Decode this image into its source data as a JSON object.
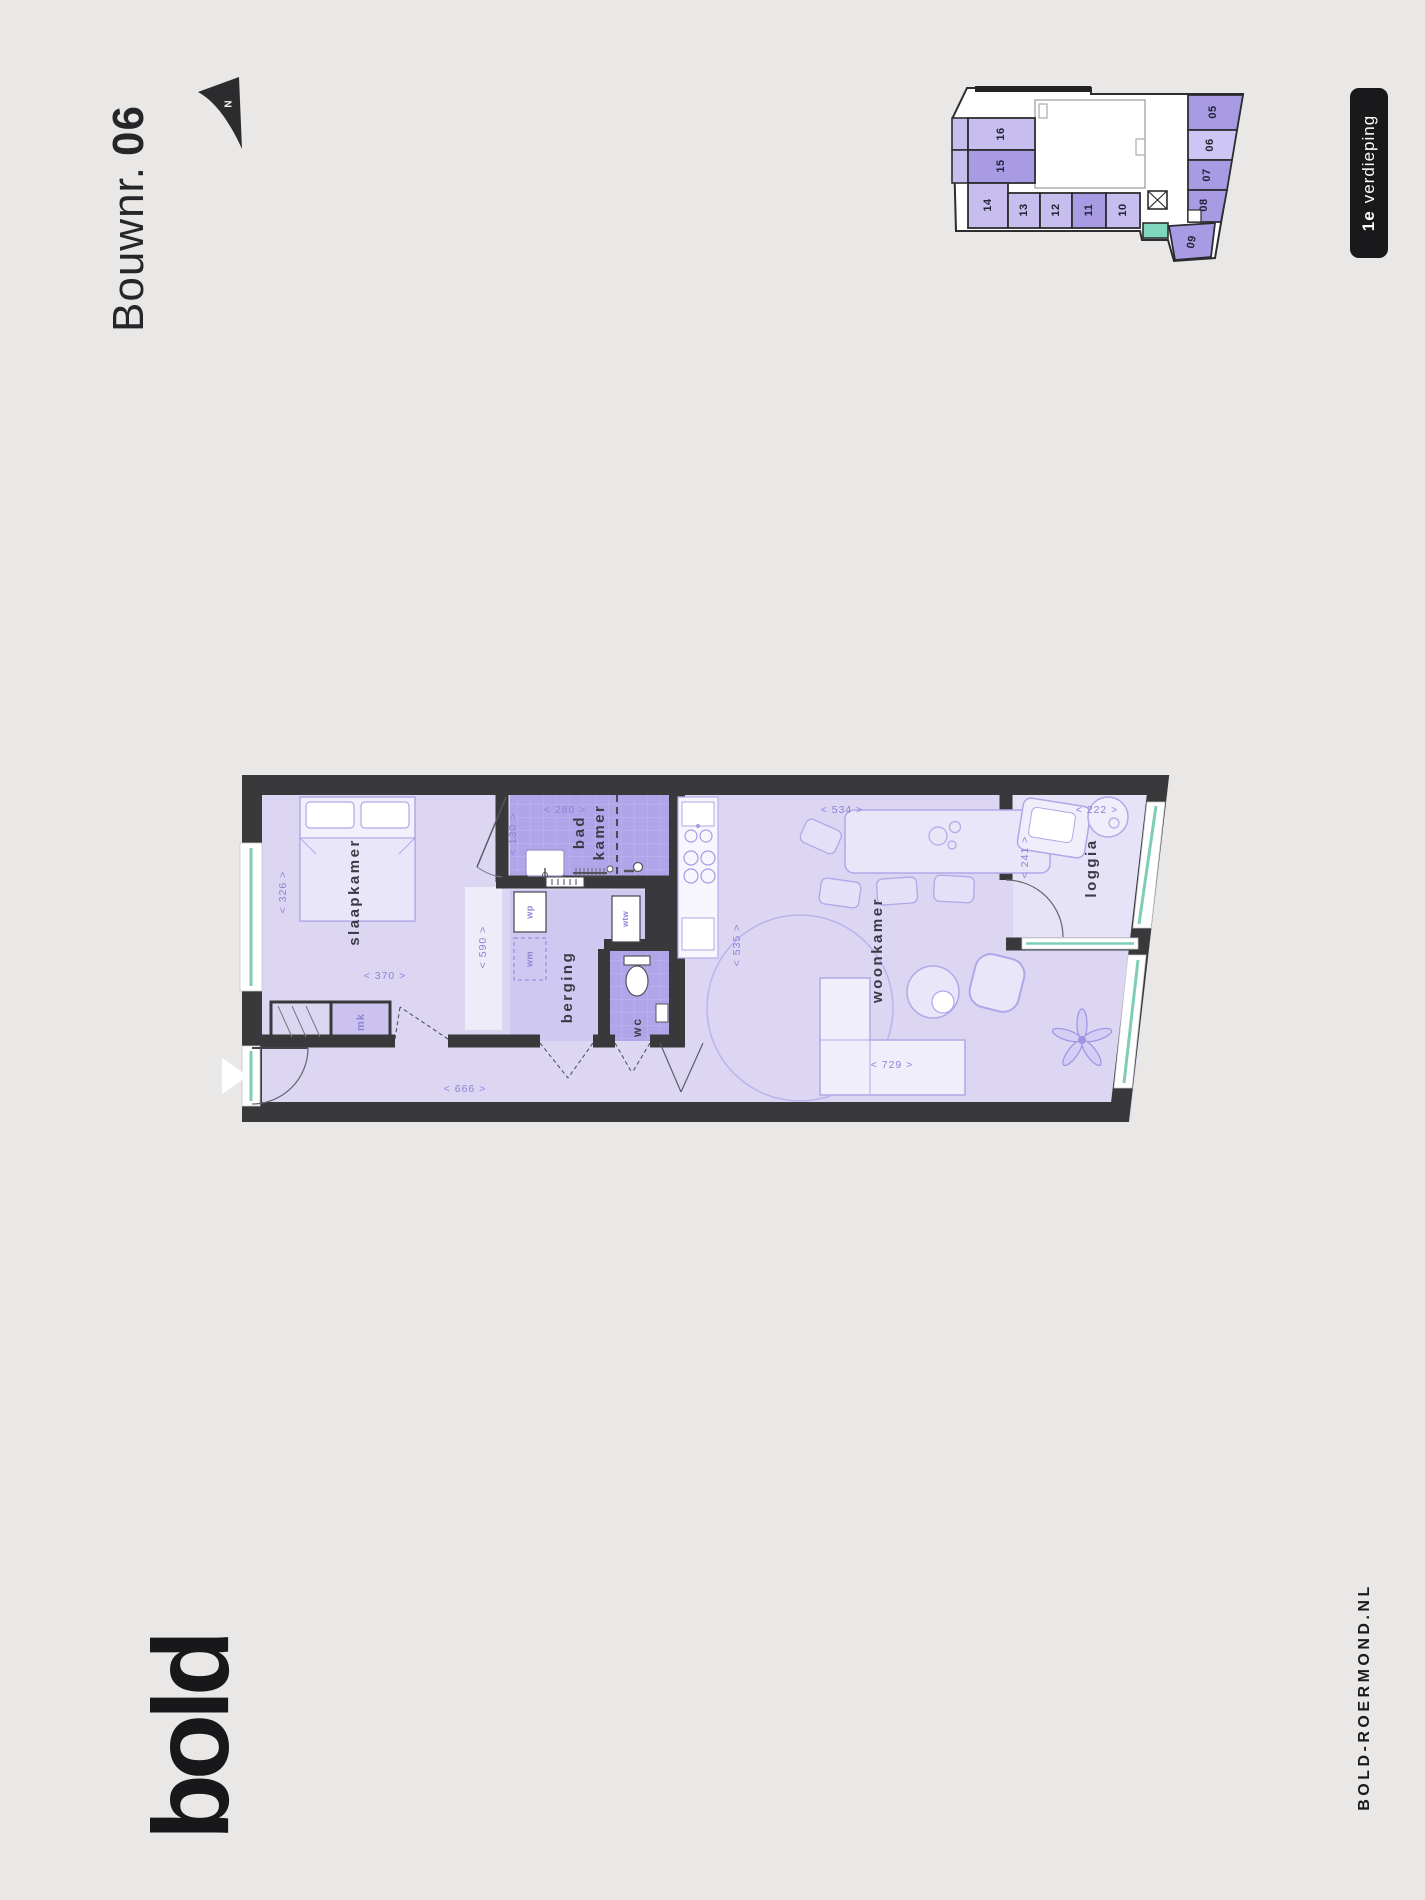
{
  "header": {
    "title_prefix": "Bouwnr.",
    "title_number": "06",
    "north_label": "N"
  },
  "floor_badge": {
    "number": "1e",
    "label": "verdieping"
  },
  "minimap": {
    "units": [
      {
        "label": "05"
      },
      {
        "label": "06"
      },
      {
        "label": "07"
      },
      {
        "label": "08"
      },
      {
        "label": "09"
      },
      {
        "label": "10"
      },
      {
        "label": "11"
      },
      {
        "label": "12"
      },
      {
        "label": "13"
      },
      {
        "label": "14"
      },
      {
        "label": "15"
      },
      {
        "label": "16"
      }
    ]
  },
  "plan": {
    "rooms": {
      "slaapkamer": "slaapkamer",
      "badkamer_line1": "bad",
      "badkamer_line2": "kamer",
      "berging": "berging",
      "wc": "wc",
      "woonkamer": "woonkamer",
      "loggia": "loggia",
      "mk": "mk"
    },
    "appliances": {
      "wp": "wp",
      "wm": "wm",
      "wtw": "wtw"
    },
    "dimensions": {
      "d326": "< 326 >",
      "d370": "< 370 >",
      "d590": "< 590 >",
      "d280": "< 280 >",
      "d130": "< 130 >",
      "d666": "< 666 >",
      "d535": "< 535 >",
      "d534": "< 534 >",
      "d729": "< 729 >",
      "d222": "< 222 >",
      "d241": "< 241 >"
    }
  },
  "footer": {
    "logo_text": "bold",
    "website": "BOLD-ROERMOND.NL"
  },
  "colors": {
    "wall": "#39393b",
    "floor": "#dcd6f3",
    "floor_light": "#e6e2f7",
    "tile": "#b1a5e9",
    "berging_floor": "#cfc8f0",
    "dim_text": "#8f81d8",
    "unit_medium": "#a89ae3",
    "unit_light": "#c7bdef",
    "unit_highlight": "#cdc5f3",
    "stair_teal": "#7ed7bd",
    "badge_bg": "#19191b"
  }
}
